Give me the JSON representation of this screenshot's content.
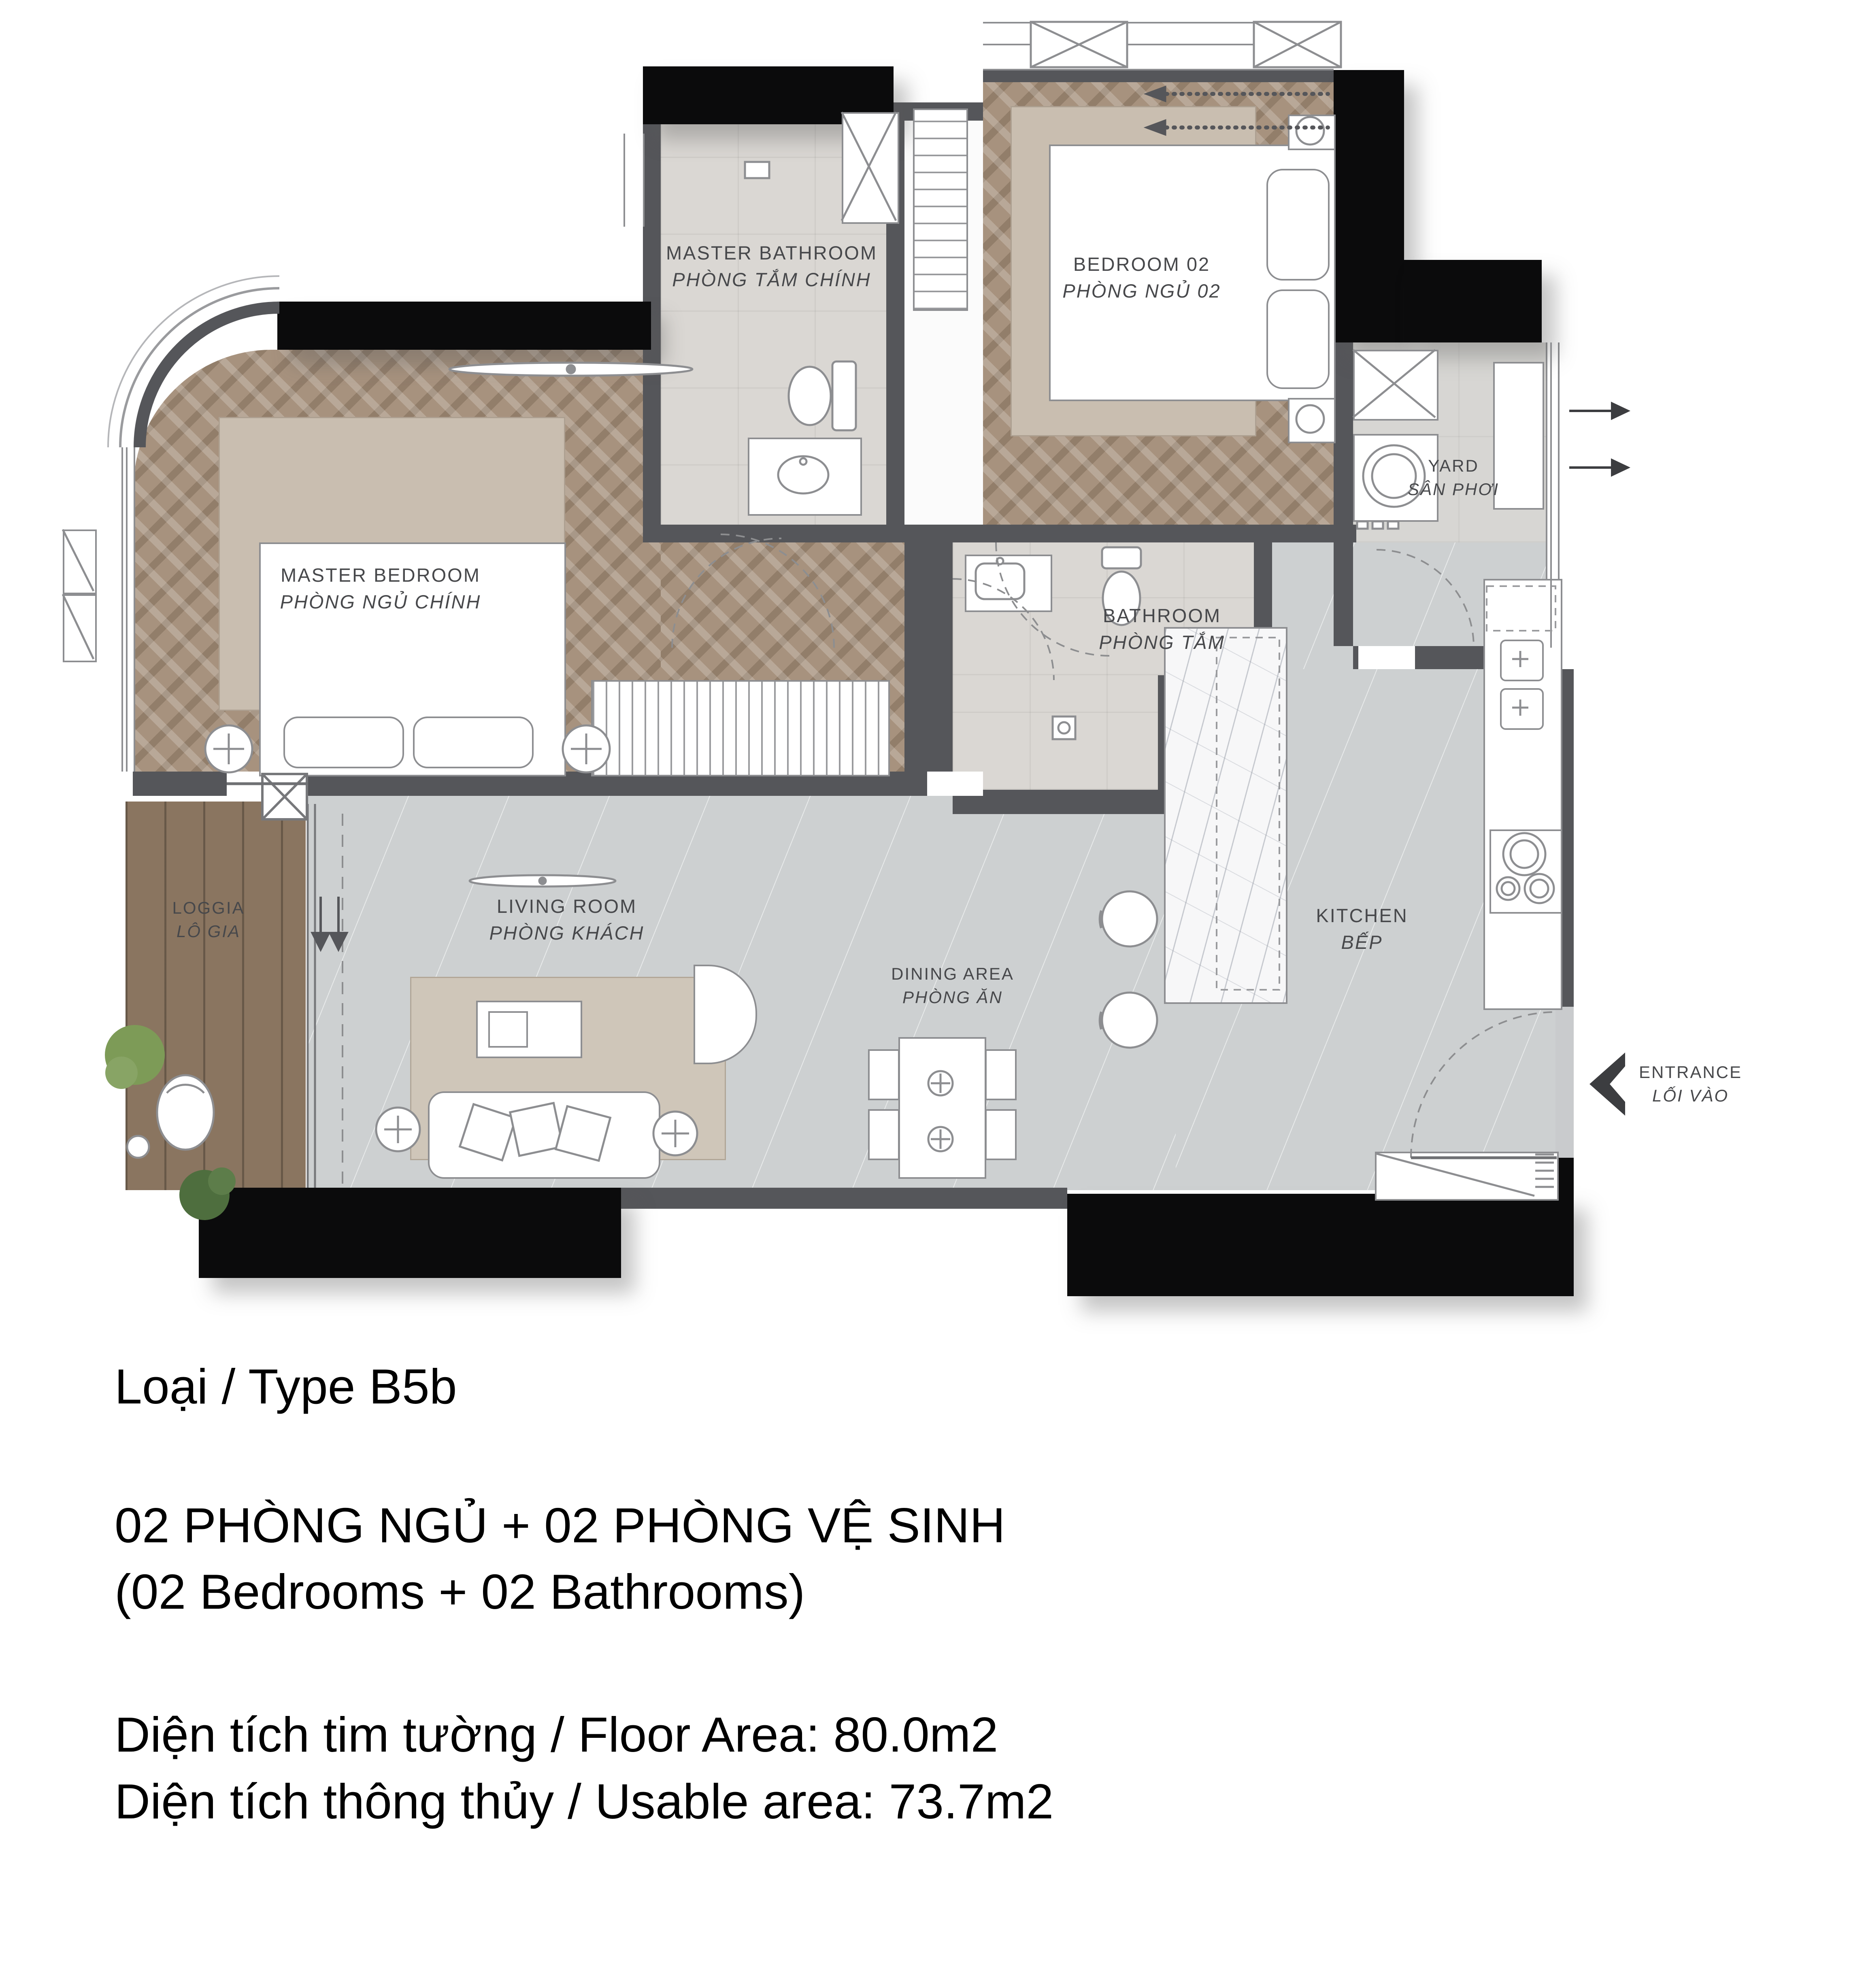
{
  "document": {
    "type_label": "Loại / Type B5b",
    "config_line_vi": "02 PHÒNG NGỦ + 02 PHÒNG VỆ SINH",
    "config_line_en": "(02 Bedrooms + 02 Bathrooms)",
    "floor_area_line": "Diện tích tim tường / Floor Area: 80.0m2",
    "usable_area_line": "Diện tích thông thủy / Usable area: 73.7m2"
  },
  "rooms": {
    "master_bathroom": {
      "en": "MASTER BATHROOM",
      "vi": "PHÒNG TẮM CHÍNH"
    },
    "bedroom_02": {
      "en": "BEDROOM 02",
      "vi": "PHÒNG NGỦ 02"
    },
    "yard": {
      "en": "YARD",
      "vi": "SÂN PHƠI"
    },
    "master_bedroom": {
      "en": "MASTER BEDROOM",
      "vi": "PHÒNG NGỦ CHÍNH"
    },
    "bathroom": {
      "en": "BATHROOM",
      "vi": "PHÒNG TẮM"
    },
    "kitchen": {
      "en": "KITCHEN",
      "vi": "BẾP"
    },
    "loggia": {
      "en": "LOGGIA",
      "vi": "LÔ GIA"
    },
    "living_room": {
      "en": "LIVING ROOM",
      "vi": "PHÒNG KHÁCH"
    },
    "dining_area": {
      "en": "DINING AREA",
      "vi": "PHÒNG ĂN"
    },
    "entrance": {
      "en": "ENTRANCE",
      "vi": "LỐI VÀO"
    }
  },
  "colors": {
    "wall_dark": "#55565a",
    "wall_black": "#0b0b0c",
    "floor_wood": "#a7927e",
    "rug": "#c9beb0",
    "rug_light": "#cfc6b9",
    "tile_bath": "#dad7d3",
    "tile_gray": "#cdd0d1",
    "tile_yard": "#d7d6d3",
    "loggia_wood": "#8a7560",
    "marble_island": "#f7f7f8",
    "label_text": "#47484b",
    "plant_green": "#7d9b57",
    "plant_dark": "#4e6e3e",
    "arrow_dark": "#3c3d40"
  }
}
